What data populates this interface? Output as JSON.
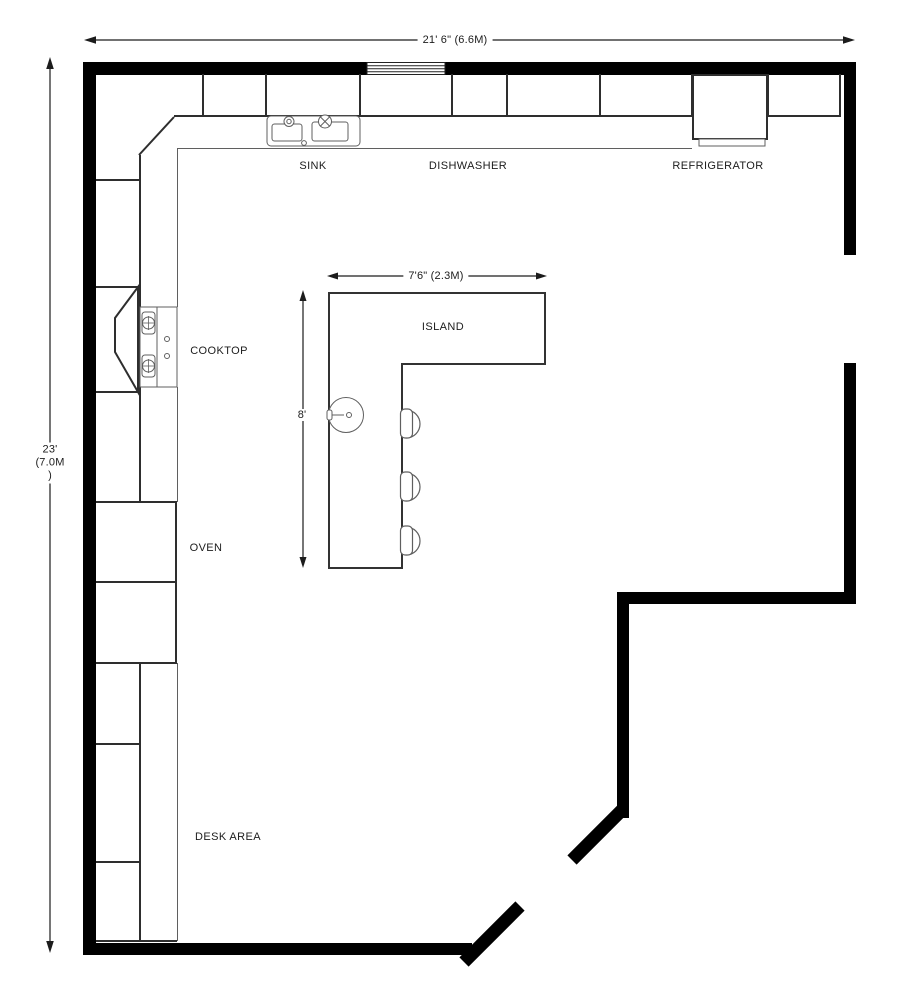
{
  "drawing": {
    "type": "kitchen-floor-plan"
  },
  "dimension_labels": {
    "overall_width": "21' 6\"  (6.6M)",
    "overall_depth_line1": "23'",
    "overall_depth_line2": "(7.0M",
    "overall_depth_line3": ")",
    "island_width": "7'6\" (2.3M)",
    "island_depth": "8'"
  },
  "labels": {
    "sink": "SINK",
    "dishwasher": "DISHWASHER",
    "refrigerator": "REFRIGERATOR",
    "cooktop": "COOKTOP",
    "oven": "OVEN",
    "island": "ISLAND",
    "desk_area": "DESK AREA"
  },
  "colors": {
    "wall": "#000000",
    "cabinet_line": "#2e2e2e",
    "counter_line": "#5f5f5f",
    "text": "#1c1c1c",
    "background": "#ffffff"
  }
}
